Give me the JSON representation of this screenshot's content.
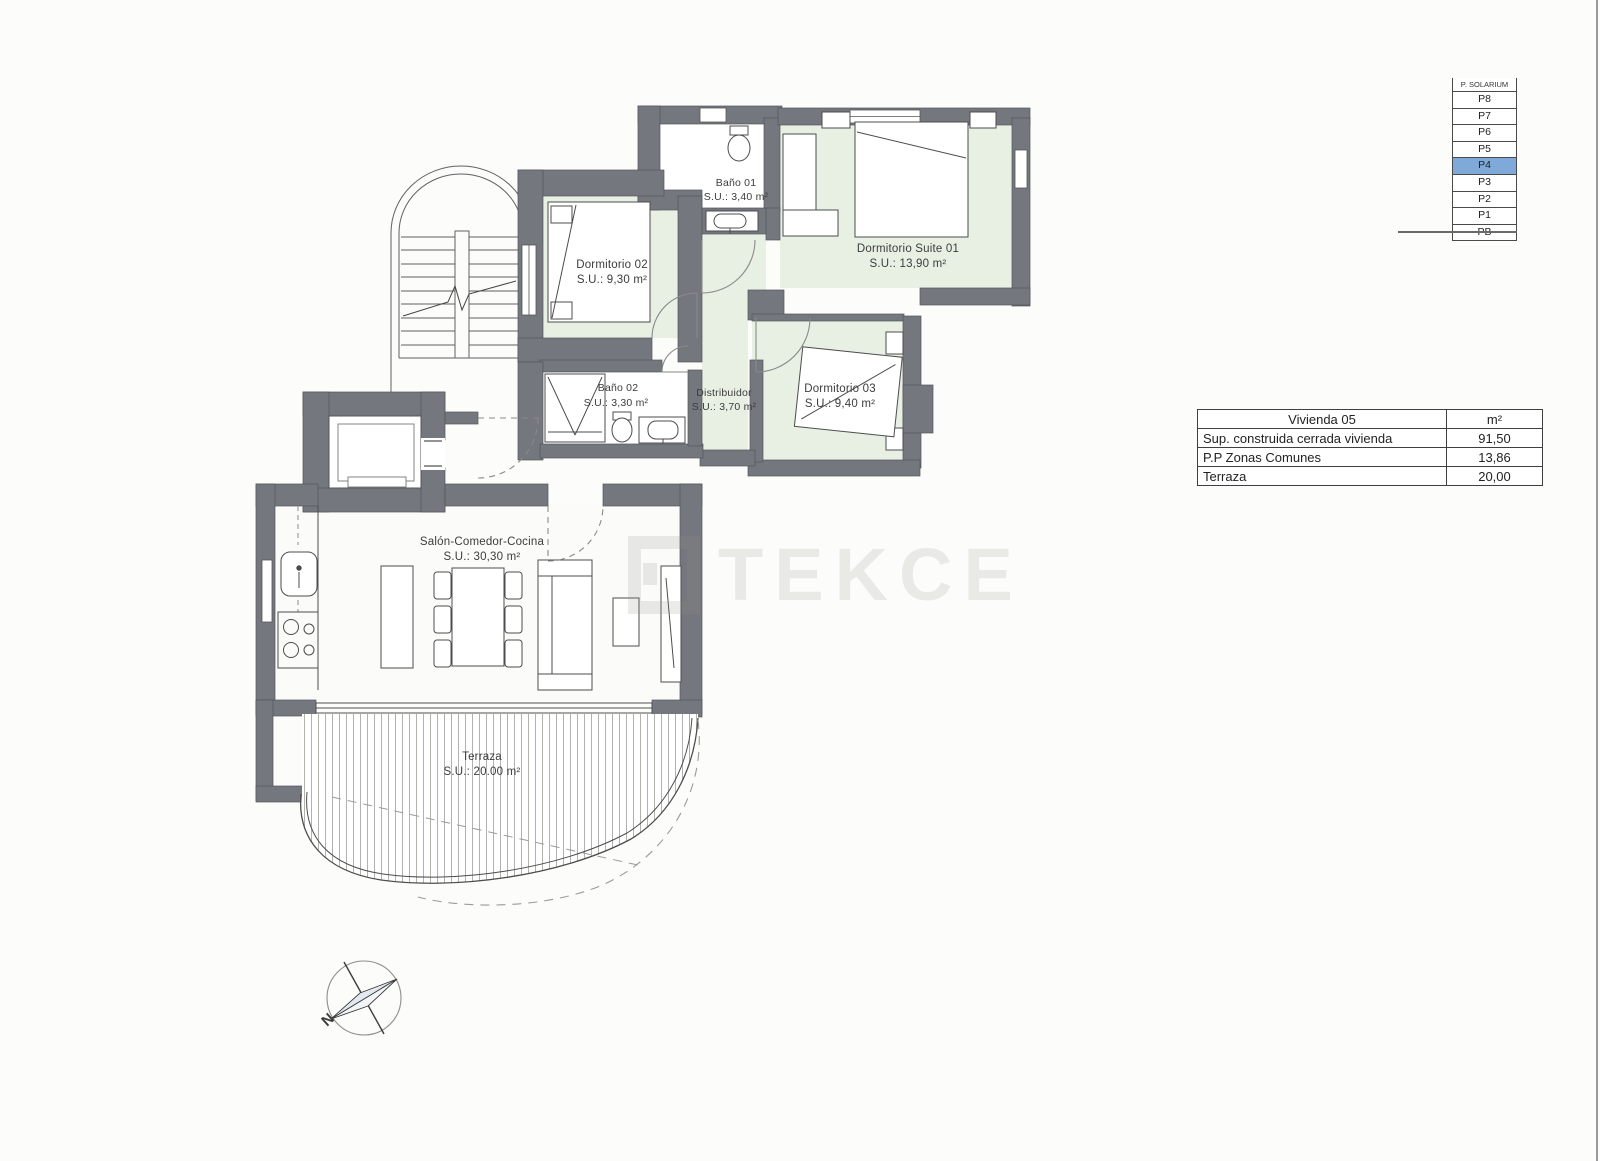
{
  "floor_selector": {
    "title": "P. SOLARIUM",
    "floors": [
      "P8",
      "P7",
      "P6",
      "P5",
      "P4",
      "P3",
      "P2",
      "P1",
      "PB"
    ],
    "selected": "P4",
    "highlight_color": "#7ea9d8"
  },
  "area_table": {
    "title": "Vivienda 05",
    "unit": "m²",
    "rows": [
      {
        "label": "Sup. construida cerrada vivienda",
        "value": "91,50"
      },
      {
        "label": "P.P Zonas Comunes",
        "value": "13,86"
      },
      {
        "label": "Terraza",
        "value": "20,00"
      }
    ]
  },
  "rooms": [
    {
      "name": "bano-01",
      "label": "Baño 01",
      "area": "S.U.: 3,40 m²"
    },
    {
      "name": "dormitorio-02",
      "label": "Dormitorio 02",
      "area": "S.U.: 9,30 m²"
    },
    {
      "name": "dormitorio-suite-01",
      "label": "Dormitorio Suite 01",
      "area": "S.U.: 13,90 m²"
    },
    {
      "name": "bano-02",
      "label": "Baño 02",
      "area": "S.U.: 3,30 m²"
    },
    {
      "name": "distribuidor",
      "label": "Distribuidor",
      "area": "S.U.: 3,70 m²"
    },
    {
      "name": "dormitorio-03",
      "label": "Dormitorio 03",
      "area": "S.U.: 9,40 m²"
    },
    {
      "name": "salon-comedor-cocina",
      "label": "Salón-Comedor-Cocina",
      "area": "S.U.: 30,30 m²"
    },
    {
      "name": "terraza",
      "label": "Terraza",
      "area": "S.U.: 20.00 m²"
    }
  ],
  "watermark": {
    "text": "TEKCE"
  },
  "compass": {
    "label": "N"
  },
  "colors": {
    "wall": "#74777d",
    "room_green": "#e8f0e4",
    "highlight": "#7ea9d8"
  }
}
